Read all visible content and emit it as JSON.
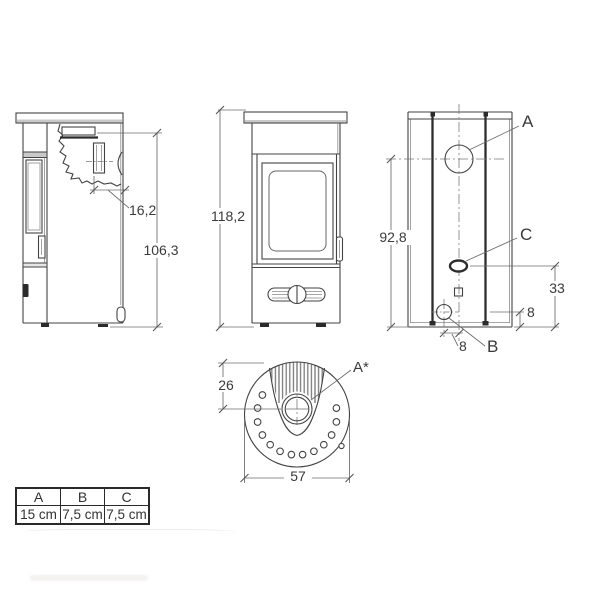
{
  "drawing_title": "stove-dimension-drawing",
  "views": {
    "side": {
      "dim_flue_offset": "16,2",
      "dim_flue_height": "106,3"
    },
    "front": {
      "dim_total_height": "118,2"
    },
    "back": {
      "dim_outlet_height": "92,8",
      "dim_c_from_floor": "33",
      "dim_b_from_floor": "8",
      "dim_b_from_center": "8",
      "label_a": "A",
      "label_b": "B",
      "label_c": "C"
    },
    "top": {
      "dim_flue_center_from_back": "26",
      "dim_diameter": "57",
      "label_a_star": "A*"
    }
  },
  "legend_table": {
    "headers": [
      "A",
      "B",
      "C"
    ],
    "values": [
      "15 cm",
      "7,5 cm",
      "7,5 cm"
    ]
  },
  "colors": {
    "line": "#434343",
    "dim": "#6b6b6b",
    "text": "#3a3a3a",
    "shade": "#c9c9c9"
  }
}
